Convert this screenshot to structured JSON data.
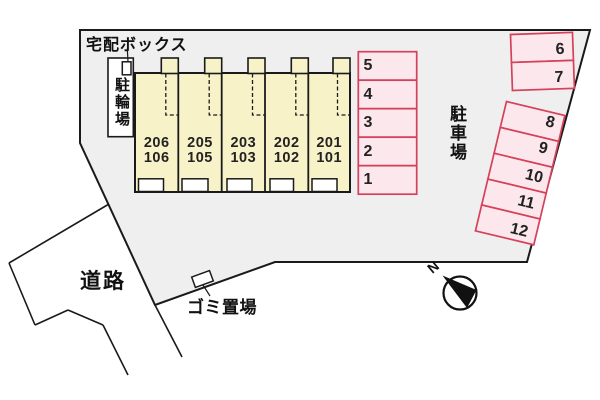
{
  "plan": {
    "labels": {
      "delivery_box": "宅配ボックス",
      "bicycle_parking": "駐輪場",
      "parking_lot": "駐車場",
      "road": "道路",
      "garbage_area": "ゴミ置場",
      "compass_north": "N"
    },
    "building_units": [
      {
        "upper": "206",
        "lower": "106"
      },
      {
        "upper": "205",
        "lower": "105"
      },
      {
        "upper": "203",
        "lower": "103"
      },
      {
        "upper": "202",
        "lower": "102"
      },
      {
        "upper": "201",
        "lower": "101"
      }
    ],
    "parking_spaces": {
      "column_1_5": [
        "5",
        "4",
        "3",
        "2",
        "1"
      ],
      "row_6_7": [
        "6",
        "7"
      ],
      "column_8_12": [
        "8",
        "9",
        "10",
        "11",
        "12"
      ]
    },
    "colors": {
      "site_fill": "#efefef",
      "building_fill": "#f7f2c8",
      "parking_fill": "#fce7ec",
      "parking_border": "#d5415a",
      "line": "#1a1a1a"
    }
  }
}
